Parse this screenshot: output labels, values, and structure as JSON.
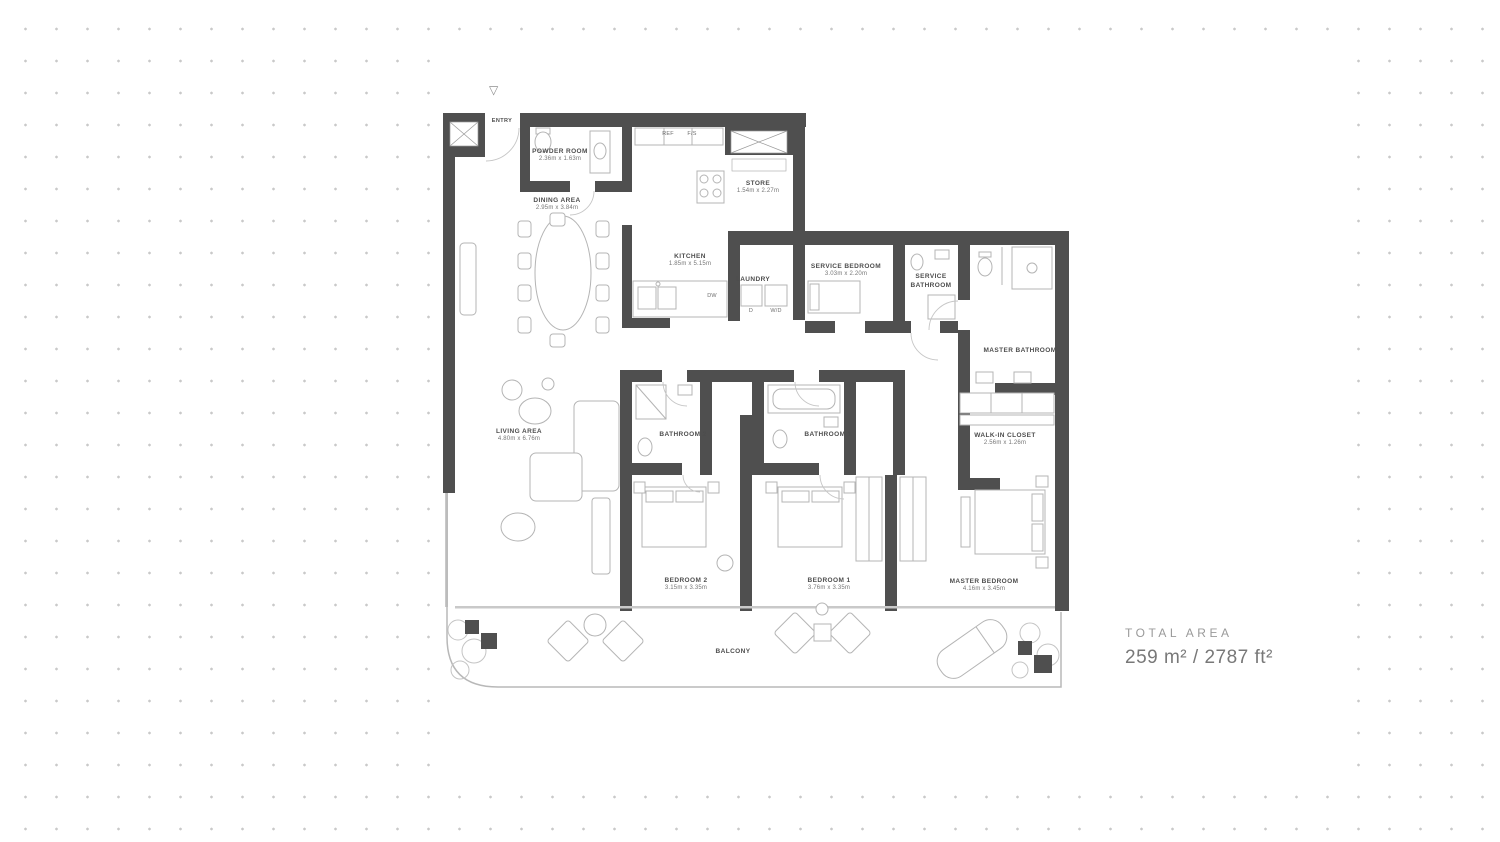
{
  "icons": {
    "entry_marker": "▽"
  },
  "plan": {
    "rooms": [
      {
        "name": "POWDER ROOM",
        "dims": "2.36m x 1.63m"
      },
      {
        "name": "DINING AREA",
        "dims": "2.95m x 3.84m"
      },
      {
        "name": "KITCHEN",
        "dims": "1.85m x 5.15m"
      },
      {
        "name": "STORE",
        "dims": "1.54m x 2.27m"
      },
      {
        "name": "LAUNDRY",
        "dims": ""
      },
      {
        "name": "SERVICE BEDROOM",
        "dims": "3.03m x 2.20m"
      },
      {
        "name": "SERVICE BATHROOM",
        "dims": ""
      },
      {
        "name": "MASTER BATHROOM",
        "dims": ""
      },
      {
        "name": "WALK-IN CLOSET",
        "dims": "2.56m x 1.26m"
      },
      {
        "name": "LIVING AREA",
        "dims": "4.80m x 6.76m"
      },
      {
        "name": "BATHROOM 2",
        "dims": ""
      },
      {
        "name": "BATHROOM 1",
        "dims": ""
      },
      {
        "name": "BEDROOM 2",
        "dims": "3.15m x 3.35m"
      },
      {
        "name": "BEDROOM 1",
        "dims": "3.76m x 3.35m"
      },
      {
        "name": "MASTER BEDROOM",
        "dims": "4.16m x 3.45m"
      },
      {
        "name": "BALCONY",
        "dims": ""
      },
      {
        "name": "ENTRY",
        "dims": ""
      }
    ],
    "appliances": {
      "ref": "REF",
      "fs": "F/S",
      "dw": "DW",
      "d": "D",
      "wd": "W/D"
    }
  },
  "total_area": {
    "label": "TOTAL AREA",
    "value": "259 m² / 2787 ft²"
  },
  "colors": {
    "wall": "#4f4f4f",
    "thin_line": "#b4b4b4",
    "glass": "#c9c9c9",
    "dot": "#c9c9c9"
  }
}
